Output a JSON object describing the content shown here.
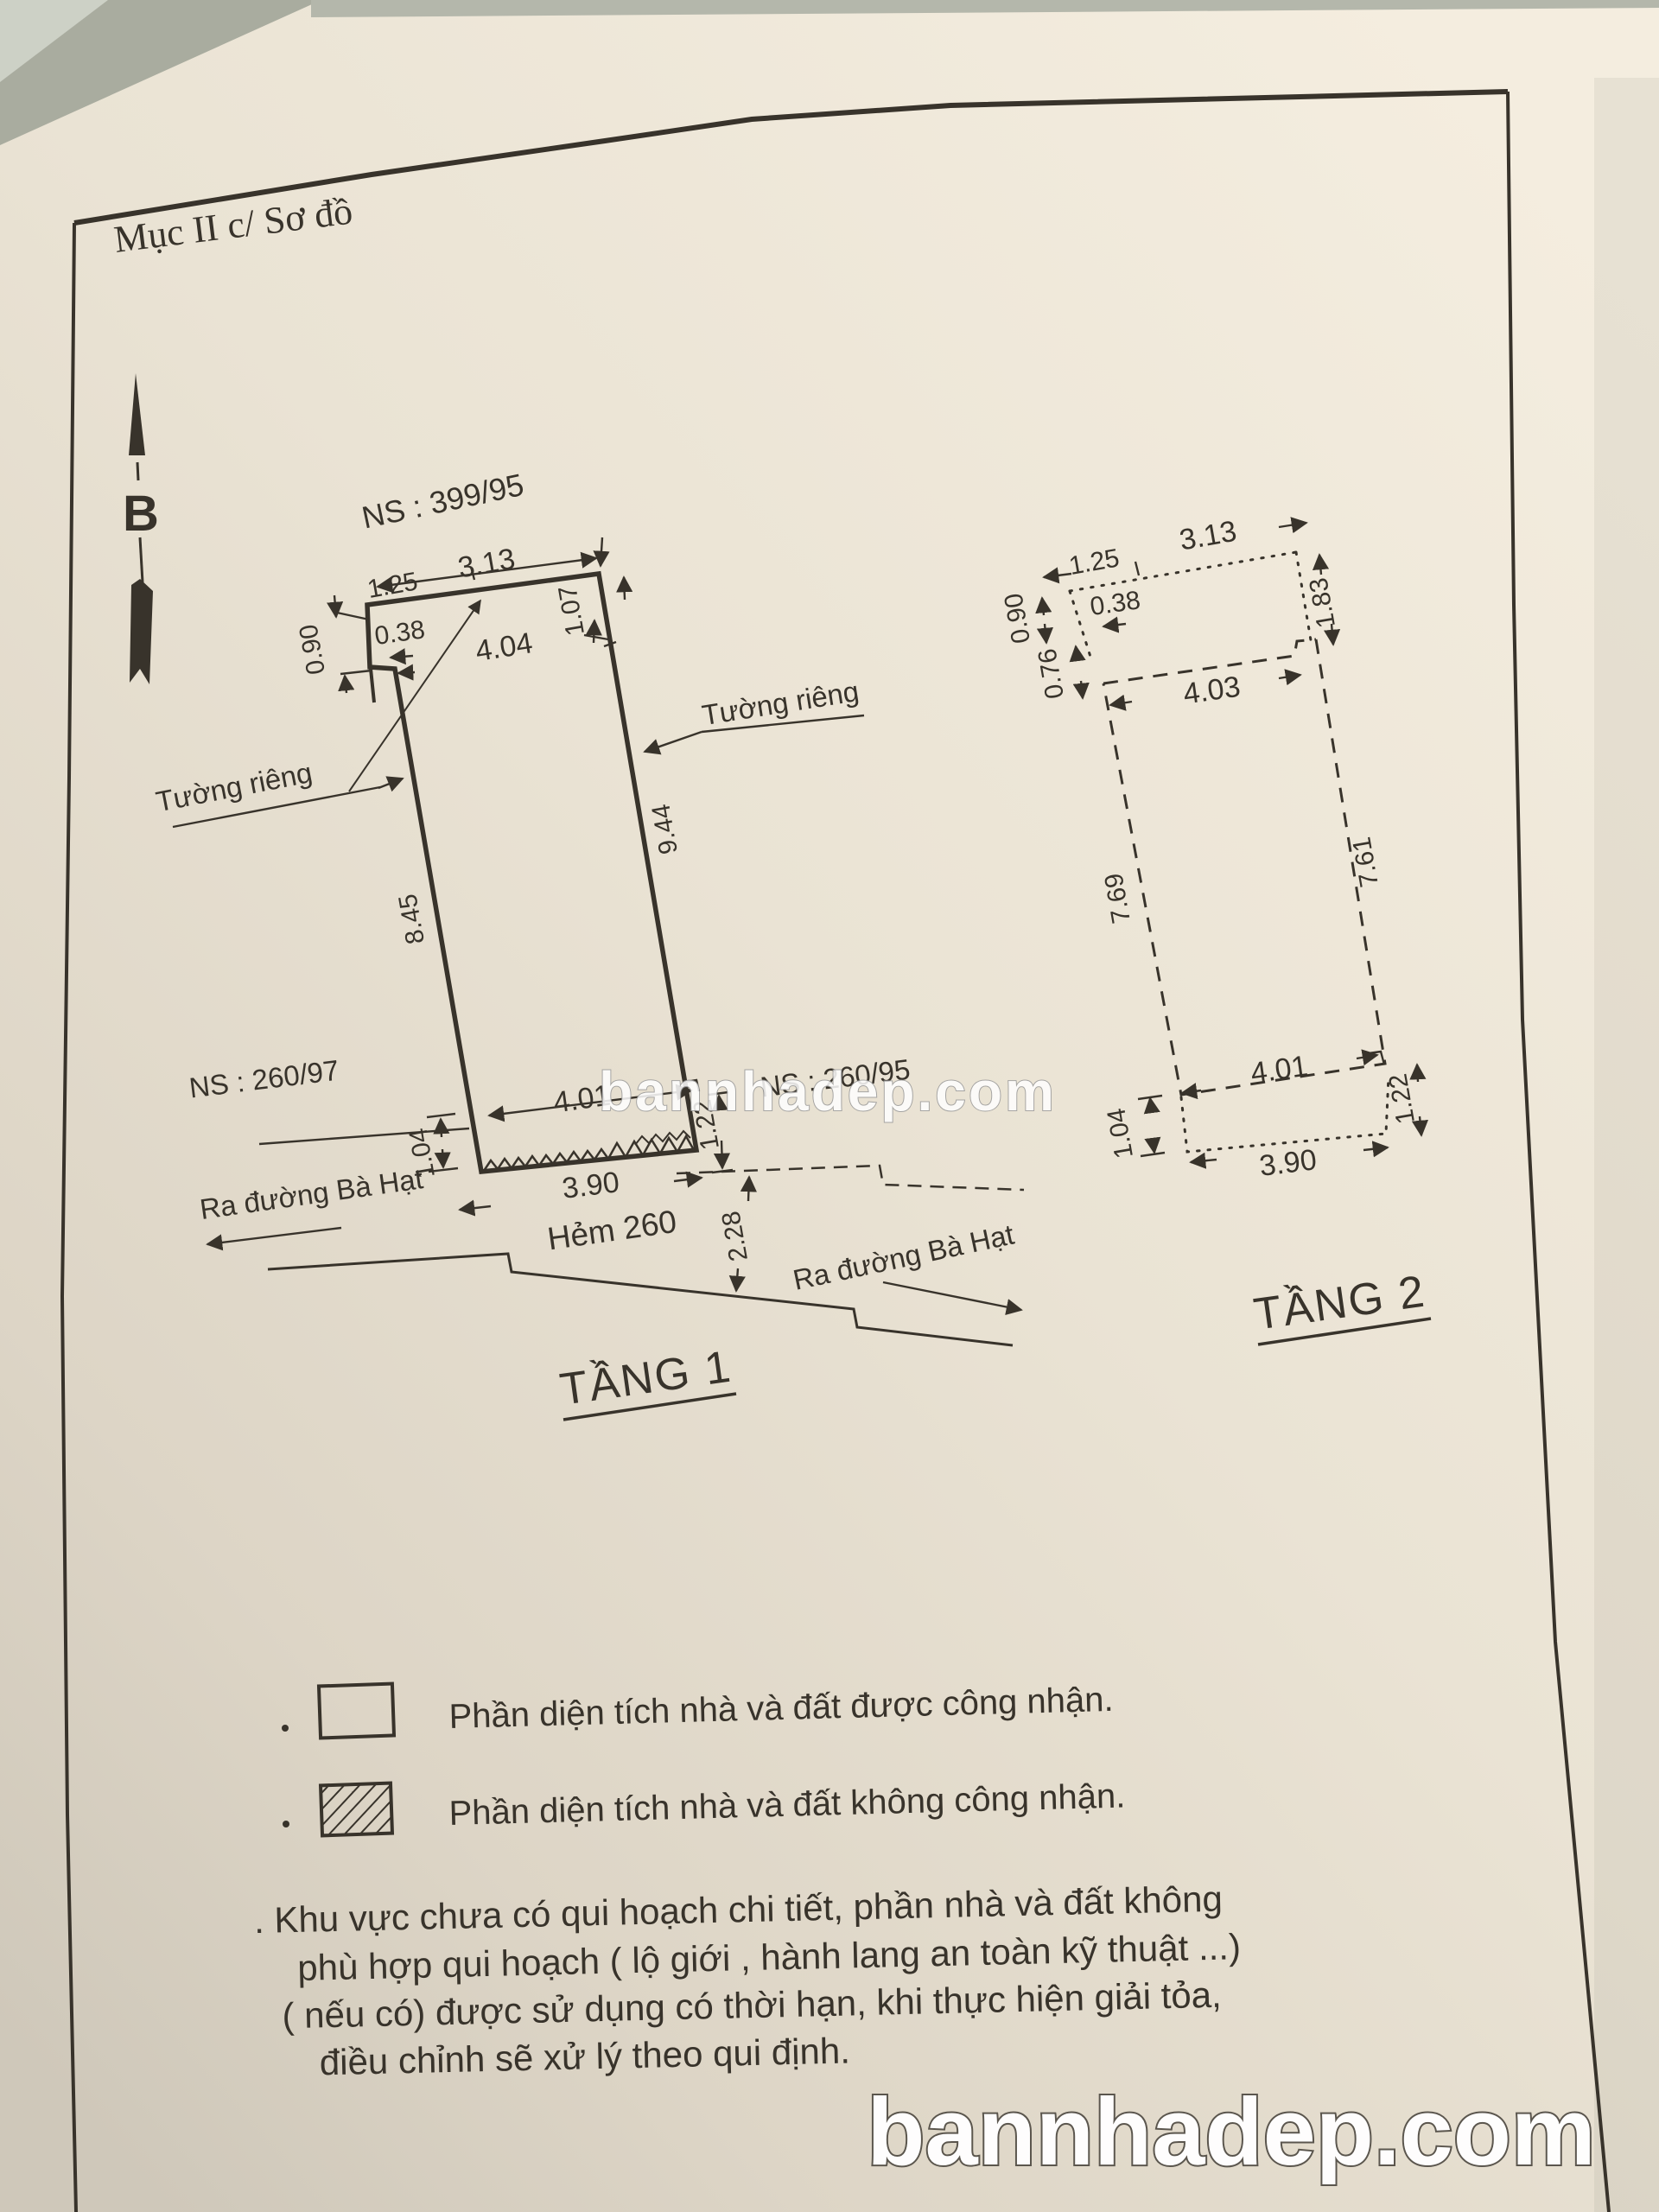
{
  "title": "Mục II c/ Sơ đồ",
  "compass": {
    "label": "B"
  },
  "watermarks": {
    "center": "bannhadep.com",
    "bottom": "bannhadep.com"
  },
  "floor1": {
    "label": "TẦNG 1",
    "parcel": "NS : 399/95",
    "neighbor_left": "NS : 260/97",
    "neighbor_right": "NS : 260/95",
    "wall_left": "Tường riêng",
    "wall_right": "Tường riêng",
    "street_left": "Ra đường Bà Hạt",
    "street_right": "Ra đường Bà Hạt",
    "alley": "Hẻm 260",
    "dims": {
      "top_seg1": "1.25",
      "top_seg2": "3.13",
      "notch_w": "0.38",
      "notch_h": "0.90",
      "top_inner": "4.04",
      "right_top": "1.07",
      "left_side": "8.45",
      "right_side": "9.44",
      "bottom_inner": "4.01",
      "strip_left": "1.04",
      "bottom_outer": "3.90",
      "strip_right": "1.22",
      "alley_width": "2.28"
    }
  },
  "floor2": {
    "label": "TẦNG 2",
    "dims": {
      "top_seg1": "1.25",
      "top_seg2": "3.13",
      "notch_w": "0.38",
      "left_top": "0.90",
      "left_mid": "0.76",
      "right_top": "1.83",
      "top_inner": "4.03",
      "left_side": "7.69",
      "right_side": "7.61",
      "bottom_inner": "4.01",
      "strip_left": "1.04",
      "bottom_outer": "3.90",
      "strip_right": "1.22"
    }
  },
  "legend": {
    "items": [
      {
        "style": "plain",
        "label": "Phần diện tích nhà và đất được công nhận."
      },
      {
        "style": "hatched",
        "label": "Phần diện tích nhà và đất không công nhận."
      }
    ]
  },
  "note": {
    "lines": [
      ". Khu vực chưa có qui hoạch chi tiết, phần nhà và đất không",
      "phù hợp qui hoạch ( lộ giới , hành lang an toàn kỹ thuật ...)",
      "( nếu có) được sử dụng có thời hạn, khi thực hiện giải tỏa,",
      "điều chỉnh sẽ xử lý theo qui định."
    ]
  },
  "colors": {
    "paper": "#ece5d6",
    "ink": "#38332b",
    "background": "#a9ac9f",
    "watermark_fill": "#ffffff",
    "watermark_outline": "#6e6a62"
  }
}
